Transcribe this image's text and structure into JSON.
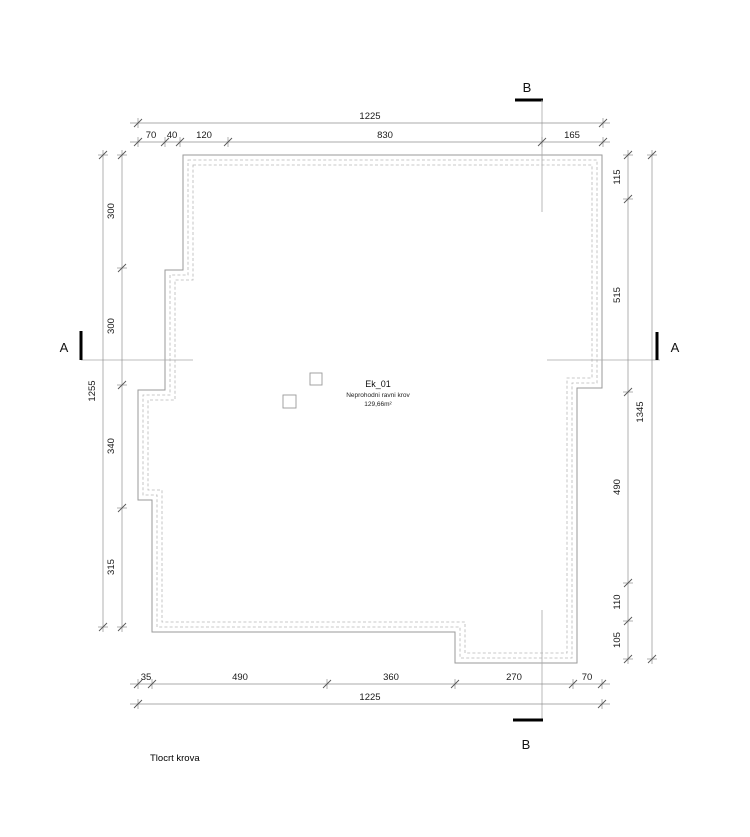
{
  "title": "Tlocrt krova",
  "roof_label": {
    "code": "Ek_01",
    "description": "Neprohodni ravni krov",
    "area": "129,66m²"
  },
  "sections": {
    "a": "A",
    "b": "B"
  },
  "dims": {
    "top": {
      "overall": "1225",
      "segments": [
        "70",
        "40",
        "120",
        "830",
        "165"
      ]
    },
    "bottom": {
      "overall": "1225",
      "segments": [
        "35",
        "490",
        "360",
        "270",
        "70"
      ]
    },
    "left": {
      "overall": "1255",
      "segments": [
        "300",
        "300",
        "340",
        "315"
      ]
    },
    "right": {
      "overall": "1345",
      "segments": [
        "115",
        "515",
        "490",
        "110",
        "105"
      ]
    }
  }
}
